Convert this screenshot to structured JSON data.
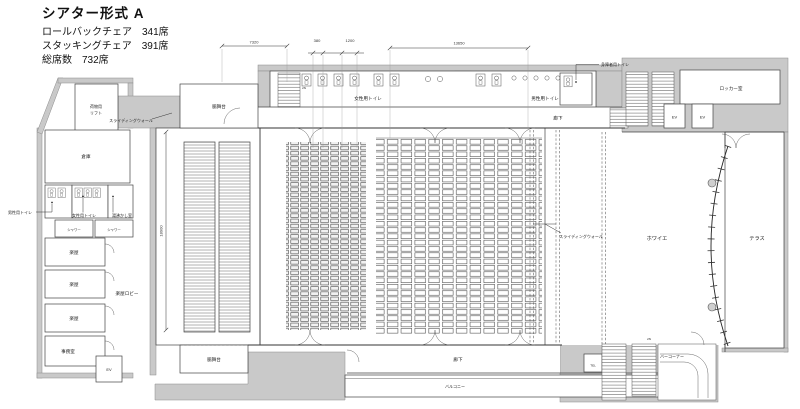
{
  "header": {
    "title": "シアター形式 A",
    "specs": [
      {
        "label": "ロールバックチェア",
        "value": "341席"
      },
      {
        "label": "スタッキングチェア",
        "value": "391席"
      },
      {
        "label": "総席数",
        "value": "732席"
      }
    ]
  },
  "dimensions": {
    "stage_block_width": "7320",
    "seat_gap": "380",
    "seat_pitch": "1200",
    "auditorium_width": "13650",
    "auditorium_depth": "18900"
  },
  "labels": {
    "cargo_lift_line1": "荷物用",
    "cargo_lift_line2": "リフト",
    "side_stage": "脇舞台",
    "sliding_wall": "スライディングウォール",
    "storage": "倉庫",
    "mens_toilet": "男性用トイレ",
    "womens_toilet": "女性用トイレ",
    "hot_water_room": "湯沸かし室",
    "shower": "シャワー",
    "dressing_room": "楽屋",
    "dressing_lobby": "楽屋ロビー",
    "office": "事務室",
    "elevator": "EV",
    "accessible_toilet": "身障者用トイレ",
    "locker_room": "ロッカー室",
    "corridor": "廊下",
    "foyer": "ホワイエ",
    "terrace": "テラス",
    "bar_corner": "バーコーナー",
    "tel": "TEL",
    "balcony": "バルコニー",
    "stair_note": "2N"
  },
  "colors": {
    "wall_fill": "#c9c9c9",
    "line": "#444444",
    "background": "#ffffff"
  }
}
